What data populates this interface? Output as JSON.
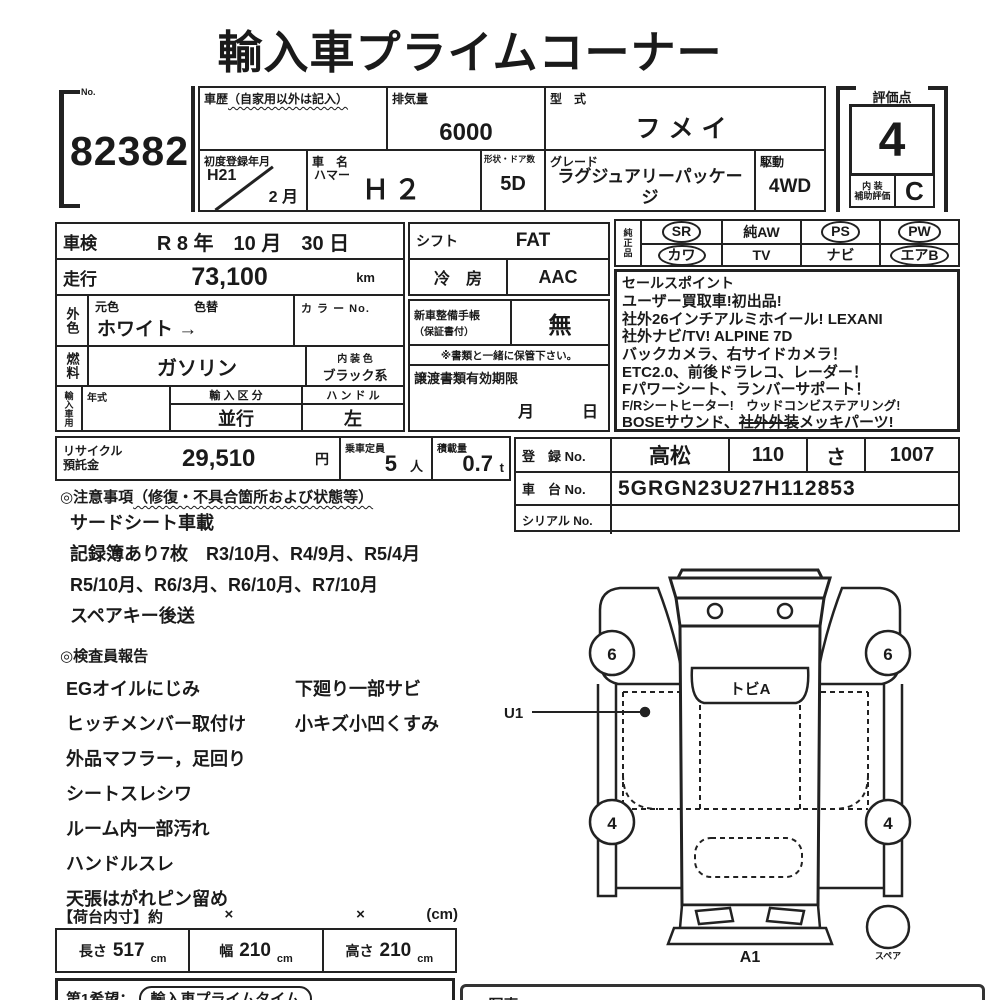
{
  "title": "輸入車プライムコーナー",
  "auction": {
    "no_label": "No.",
    "number": "82382"
  },
  "header": {
    "history_label": "車歴",
    "history_note": "（自家用以外は記入）",
    "history_value": "",
    "displacement_label": "排気量",
    "displacement_value": "6000",
    "model_label": "型　式",
    "model_value": "フメイ",
    "first_reg_label": "初度登録年月",
    "first_reg_year": "H21",
    "first_reg_month": "2 月",
    "car_name_label": "車　名",
    "car_maker": "ハマー",
    "car_name_value": "Ｈ２",
    "shape_label": "形状・ドア数",
    "shape_value": "5D",
    "grade_label": "グレード",
    "grade_value": "ラグジュアリーパッケージ",
    "drive_label": "駆動",
    "drive_value": "4WD",
    "score_label": "評価点",
    "score_value": "4",
    "interior_label_1": "内 装",
    "interior_label_2": "補助評価",
    "interior_value": "C"
  },
  "info": {
    "shaken_label": "車検",
    "shaken_value": "R 8 年　10 月　30 日",
    "mileage_label": "走行",
    "mileage_value": "73,100",
    "mileage_unit": "km",
    "ext_side_label": "外色",
    "orig_color_label": "元色",
    "recolor_label": "色替",
    "color_value": "ホワイト",
    "color_arrow": "→",
    "color_no_label": "カ ラ ー No.",
    "fuel_side_label": "燃料",
    "fuel_value": "ガソリン",
    "interior_color_label": "内 装 色",
    "interior_color_value": "ブラック系",
    "import_side_label": "輸入車用",
    "year_label": "年式",
    "year_value": "",
    "import_class_label": "輸 入 区 分",
    "import_class_value": "並行",
    "handle_label": "ハ ン ド ル",
    "handle_value": "左",
    "shift_label": "シフト",
    "shift_value": "FAT",
    "ac_label": "冷　房",
    "ac_value": "AAC",
    "book_label_1": "新車整備手帳",
    "book_label_2": "（保証書付）",
    "book_value": "無",
    "keep_note": "※書類と一緒に保管下さい。",
    "transfer_label": "譲渡書類有効期限",
    "transfer_value": "月　　　日"
  },
  "genuine": {
    "side_label": "純正品",
    "items": [
      {
        "label": "SR",
        "circled": true
      },
      {
        "label": "純AW",
        "circled": false
      },
      {
        "label": "PS",
        "circled": true
      },
      {
        "label": "PW",
        "circled": true
      },
      {
        "label": "カワ",
        "circled": true
      },
      {
        "label": "TV",
        "circled": false
      },
      {
        "label": "ナビ",
        "circled": false
      },
      {
        "label": "エアB",
        "circled": true
      }
    ]
  },
  "sales": {
    "label": "セールスポイント",
    "lines": [
      "ユーザー買取車!初出品!",
      "社外26インチアルミホイール! LEXANI",
      "社外ナビ/TV! ALPINE 7D",
      "バックカメラ、右サイドカメラ！",
      "ETC2.0、前後ドラレコ、レーダー！",
      "Fパワーシート、ランバーサポート！",
      "F/Rシートヒーター!　ウッドコンビステアリング!"
    ],
    "line8_prefix": "BOSEサウンド、",
    "line8_struck": "社外外装",
    "line8_suffix": "メッキパーツ!"
  },
  "recycle": {
    "label_1": "リサイクル",
    "label_2": "預託金",
    "value": "29,510",
    "unit": "円"
  },
  "capacity": {
    "label": "乗車定員",
    "value": "5",
    "unit": "人"
  },
  "load": {
    "label": "積載量",
    "value": "0.7",
    "unit": "t"
  },
  "registration": {
    "reg_label": "登　録 No.",
    "reg_area": "高松",
    "reg_class": "110",
    "reg_kana": "さ",
    "reg_num": "1007",
    "chassis_label": "車　台 No.",
    "chassis_value": "5GRGN23U27H112853",
    "serial_label": "シリアル No.",
    "serial_value": ""
  },
  "notes": {
    "heading": "◎注意事項",
    "heading_note": "（修復・不具合箇所および状態等）",
    "lines": [
      "サードシート車載",
      "記録簿あり7枚　R3/10月、R4/9月、R5/4月",
      "R5/10月、R6/3月、R6/10月、R7/10月",
      "スペアキー後送"
    ]
  },
  "report": {
    "heading": "◎検査員報告",
    "col1": [
      "EGオイルにじみ",
      "ヒッチメンバー取付け",
      "外品マフラー，足回り",
      "シートスレシワ",
      "ルーム内一部汚れ",
      "ハンドルスレ",
      "天張はがれピン留め"
    ],
    "col2": [
      "下廻り一部サビ",
      "小キズ小凹くすみ"
    ]
  },
  "cargo": {
    "heading": "【荷台内寸】約",
    "x1": "×",
    "x2": "×",
    "unit": "(cm)",
    "length_label": "長さ",
    "length_value": "517",
    "width_label": "幅",
    "width_value": "210",
    "height_label": "高さ",
    "height_value": "210",
    "cm": "cm"
  },
  "bottom": {
    "wish_label": "第1希望：",
    "wish_value": "輸入車プライムタイム",
    "memo_partial": "◆写真"
  },
  "diagram": {
    "windshield_mark": "トビA",
    "front_left_tire": "6",
    "front_right_tire": "6",
    "rear_left_tire": "4",
    "rear_right_tire": "4",
    "u1_label": "U1",
    "rear_mark": "A1",
    "spare_label": "スペア"
  }
}
